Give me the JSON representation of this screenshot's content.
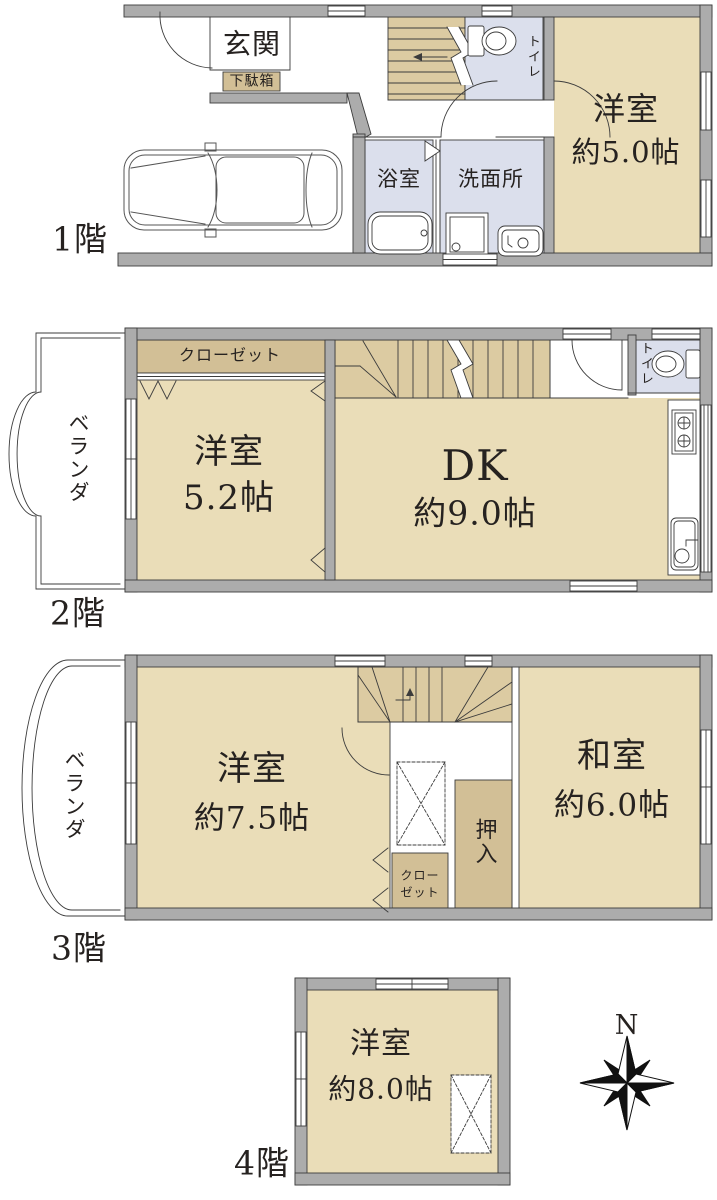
{
  "colors": {
    "room_tan": "#EADDB8",
    "stairs_tan": "#DCCBA2",
    "storage_tan": "#D2BF96",
    "wet_blue": "#DBDFEC",
    "wall_gray": "#ACACAC",
    "line": "#3C3C3C"
  },
  "floor1": {
    "name": "1階",
    "entrance": "玄関",
    "shoe_cabinet": "下駄箱",
    "bathroom": "浴室",
    "washroom": "洗面所",
    "toilet": "トイレ",
    "western_room": "洋室",
    "western_room_size": "約5.0帖"
  },
  "floor2": {
    "name": "2階",
    "veranda": "ベランダ",
    "closet": "クローゼット",
    "western_room": "洋室",
    "western_room_size": "5.2帖",
    "dining_kitchen": "DK",
    "dining_kitchen_size": "約9.0帖",
    "toilet": "トイレ"
  },
  "floor3": {
    "name": "3階",
    "veranda": "ベランダ",
    "western_room": "洋室",
    "western_room_size": "約7.5帖",
    "japanese_room": "和室",
    "japanese_room_size": "約6.0帖",
    "oshiire": "押入",
    "closet_line1": "クロー",
    "closet_line2": "ゼット"
  },
  "floor4": {
    "name": "4階",
    "western_room": "洋室",
    "western_room_size": "約8.0帖"
  },
  "compass": {
    "north": "N"
  }
}
